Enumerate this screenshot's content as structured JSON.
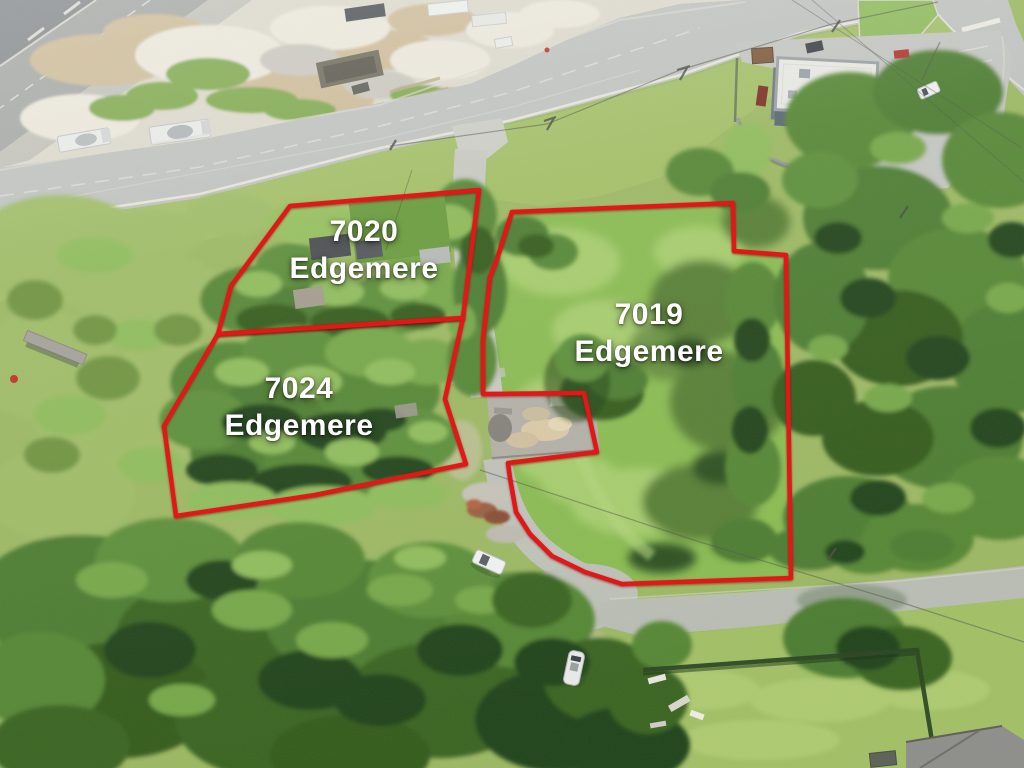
{
  "annotation": {
    "outline_color": "#e21717",
    "label_color": "#ffffff"
  },
  "parcels": [
    {
      "id": "7020-edgemere",
      "number": "7020",
      "street": "Edgemere",
      "polygon_points": "290,206 479,190 463,318 218,334 231,286"
    },
    {
      "id": "7024-edgemere",
      "number": "7024",
      "street": "Edgemere",
      "polygon_points": "218,334 463,318 445,399 466,464 315,495 176,516 164,426"
    },
    {
      "id": "7019-edgemere",
      "number": "7019",
      "street": "Edgemere",
      "polygon_points": "512,212 733,203 734,251 786,255 791,578 622,584 585,572 552,556 530,534 516,512 510,478 508,463 597,452 584,393 483,394 483,340 490,277 497,259"
    }
  ]
}
